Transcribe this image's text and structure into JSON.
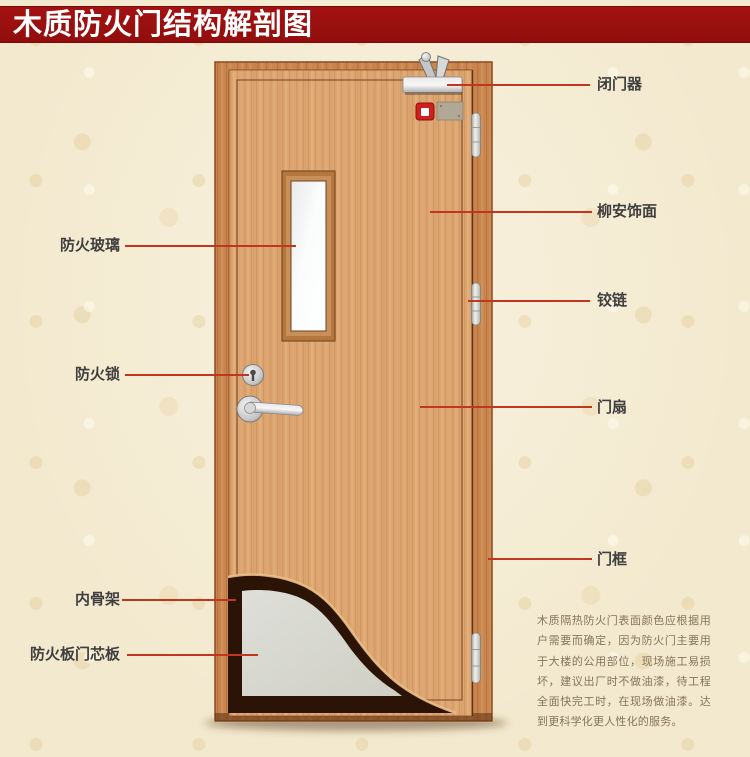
{
  "title": "木质防火门结构解剖图",
  "labels": {
    "left": [
      {
        "text": "防火玻璃"
      },
      {
        "text": "防火锁"
      },
      {
        "text": "内骨架"
      },
      {
        "text": "防火板门芯板"
      }
    ],
    "right": [
      {
        "text": "闭门器"
      },
      {
        "text": "柳安饰面"
      },
      {
        "text": "铰链"
      },
      {
        "text": "门扇"
      },
      {
        "text": "门框"
      }
    ]
  },
  "description": "木质隔热防火门表面颜色应根据用户需要而确定，因为防火门主要用于大楼的公用部位，现场施工易损坏，建议出厂时不做油漆，待工程全面快完工时，在现场做油漆。达到更科学化更人性化的服务。",
  "colors": {
    "banner": "#9d1010",
    "banner_text": "#ffffff",
    "leader_line": "#c03620",
    "label_text": "#3f3f3f",
    "description_text": "#85755a",
    "background": "#f3e9cf",
    "wood_leaf": "#d79a63",
    "wood_frame": "#c9854e",
    "core_board": "#d9d9d1",
    "inner_skeleton": "#2b1406",
    "metal": "#c9c9c9",
    "indicator_red": "#cf1f1f"
  }
}
